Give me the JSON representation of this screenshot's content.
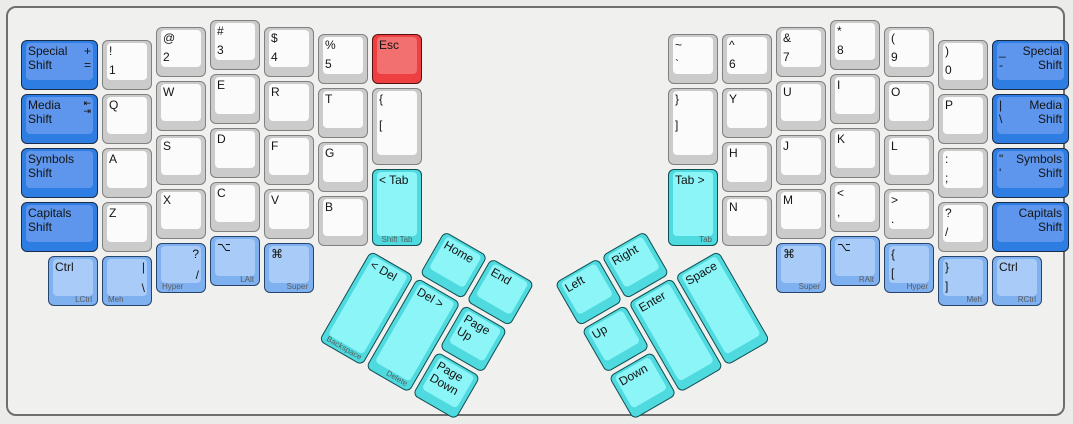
{
  "palette": {
    "gray": {
      "base": "#cbcbcb",
      "top": "#fbfbfb",
      "border": "#808080"
    },
    "blue": {
      "base": "#2e7de2",
      "top": "#5d96ec",
      "border": "#1a2c46"
    },
    "lightblue": {
      "base": "#7fb0f0",
      "top": "#a9cbf7",
      "border": "#27446b"
    },
    "cyan": {
      "base": "#4edade",
      "top": "#8bf5f7",
      "border": "#114d50"
    },
    "red": {
      "base": "#ee4040",
      "top": "#f37070",
      "border": "#561010"
    }
  },
  "case": {
    "fill": "#f0f0ef",
    "border": "#6e6e6e",
    "background": "#ebebea"
  },
  "thumb_groups": {
    "lt": {
      "name": "left-thumb-cluster",
      "cx": 362,
      "cy": 239.5,
      "angle": 30
    },
    "rt": {
      "name": "right-thumb-cluster",
      "cx": 711,
      "cy": 239.5,
      "angle": -30
    }
  },
  "keys": [
    {
      "n": "special-shift-left",
      "c": "blue",
      "x": 11,
      "y": 30,
      "w": 81,
      "L": [
        {
          "p": "tl",
          "t": "Special\nShift"
        },
        {
          "p": "tr",
          "t": "+\n="
        }
      ]
    },
    {
      "n": "exclamation-1",
      "x": 92,
      "y": 30,
      "L": [
        {
          "p": "tl",
          "t": "!"
        },
        {
          "p": "bl",
          "t": "1"
        }
      ]
    },
    {
      "n": "at-2",
      "x": 146,
      "y": 17,
      "L": [
        {
          "p": "tl",
          "t": "@"
        },
        {
          "p": "bl",
          "t": "2"
        }
      ]
    },
    {
      "n": "hash-3",
      "x": 200,
      "y": 10,
      "L": [
        {
          "p": "tl",
          "t": "#"
        },
        {
          "p": "bl",
          "t": "3"
        }
      ]
    },
    {
      "n": "dollar-4",
      "x": 254,
      "y": 17,
      "L": [
        {
          "p": "tl",
          "t": "$"
        },
        {
          "p": "bl",
          "t": "4"
        }
      ]
    },
    {
      "n": "percent-5",
      "x": 308,
      "y": 24,
      "L": [
        {
          "p": "tl",
          "t": "%"
        },
        {
          "p": "bl",
          "t": "5"
        }
      ]
    },
    {
      "n": "esc",
      "c": "red",
      "x": 362,
      "y": 24,
      "L": [
        {
          "p": "tl",
          "t": "Esc"
        }
      ]
    },
    {
      "n": "media-shift-left",
      "c": "blue",
      "x": 11,
      "y": 84,
      "w": 81,
      "L": [
        {
          "p": "tl",
          "t": "Media\nShift"
        },
        {
          "p": "tr",
          "t": "⇤\n⇥",
          "i": 1
        }
      ]
    },
    {
      "n": "q",
      "x": 92,
      "y": 84,
      "L": [
        {
          "p": "tl",
          "t": "Q"
        }
      ]
    },
    {
      "n": "w",
      "x": 146,
      "y": 71,
      "L": [
        {
          "p": "tl",
          "t": "W"
        }
      ]
    },
    {
      "n": "e",
      "x": 200,
      "y": 64,
      "L": [
        {
          "p": "tl",
          "t": "E"
        }
      ]
    },
    {
      "n": "r",
      "x": 254,
      "y": 71,
      "L": [
        {
          "p": "tl",
          "t": "R"
        }
      ]
    },
    {
      "n": "t",
      "x": 308,
      "y": 78,
      "L": [
        {
          "p": "tl",
          "t": "T"
        }
      ]
    },
    {
      "n": "lbrace-lbracket",
      "x": 362,
      "y": 78,
      "h": 81,
      "L": [
        {
          "p": "tl",
          "t": "{"
        },
        {
          "p": "ml",
          "t": "["
        }
      ]
    },
    {
      "n": "symbols-shift-left",
      "c": "blue",
      "x": 11,
      "y": 138,
      "w": 81,
      "L": [
        {
          "p": "tl",
          "t": "Symbols\nShift"
        }
      ]
    },
    {
      "n": "a",
      "x": 92,
      "y": 138,
      "L": [
        {
          "p": "tl",
          "t": "A"
        }
      ]
    },
    {
      "n": "s",
      "x": 146,
      "y": 125,
      "L": [
        {
          "p": "tl",
          "t": "S"
        }
      ]
    },
    {
      "n": "d",
      "x": 200,
      "y": 118,
      "L": [
        {
          "p": "tl",
          "t": "D"
        }
      ]
    },
    {
      "n": "f",
      "x": 254,
      "y": 125,
      "L": [
        {
          "p": "tl",
          "t": "F"
        }
      ]
    },
    {
      "n": "g",
      "x": 308,
      "y": 132,
      "L": [
        {
          "p": "tl",
          "t": "G"
        }
      ]
    },
    {
      "n": "shift-tab-left",
      "c": "cyan",
      "x": 362,
      "y": 159,
      "h": 81,
      "L": [
        {
          "p": "tl",
          "t": "< Tab"
        },
        {
          "p": "fc",
          "t": "Shift Tab",
          "s": 1
        }
      ]
    },
    {
      "n": "capitals-shift-left",
      "c": "blue",
      "x": 11,
      "y": 192,
      "w": 81,
      "L": [
        {
          "p": "tl",
          "t": "Capitals\nShift"
        }
      ]
    },
    {
      "n": "z",
      "x": 92,
      "y": 192,
      "L": [
        {
          "p": "tl",
          "t": "Z"
        }
      ]
    },
    {
      "n": "x",
      "x": 146,
      "y": 179,
      "L": [
        {
          "p": "tl",
          "t": "X"
        }
      ]
    },
    {
      "n": "c",
      "x": 200,
      "y": 172,
      "L": [
        {
          "p": "tl",
          "t": "C"
        }
      ]
    },
    {
      "n": "v",
      "x": 254,
      "y": 179,
      "L": [
        {
          "p": "tl",
          "t": "V"
        }
      ]
    },
    {
      "n": "b",
      "x": 308,
      "y": 186,
      "L": [
        {
          "p": "tl",
          "t": "B"
        }
      ]
    },
    {
      "n": "lctrl",
      "c": "lightblue",
      "x": 38,
      "y": 246,
      "L": [
        {
          "p": "tl",
          "t": "Ctrl"
        },
        {
          "p": "fr",
          "t": "LCtrl",
          "s": 1
        }
      ]
    },
    {
      "n": "meh-left",
      "c": "lightblue",
      "x": 92,
      "y": 246,
      "L": [
        {
          "p": "tr",
          "t": "|"
        },
        {
          "p": "br",
          "t": "\\"
        },
        {
          "p": "fl",
          "t": "Meh",
          "s": 1
        }
      ]
    },
    {
      "n": "hyper-left",
      "c": "lightblue",
      "x": 146,
      "y": 233,
      "L": [
        {
          "p": "tr",
          "t": "?"
        },
        {
          "p": "br",
          "t": "/"
        },
        {
          "p": "fl",
          "t": "Hyper",
          "s": 1
        }
      ]
    },
    {
      "n": "lalt",
      "c": "lightblue",
      "x": 200,
      "y": 226,
      "L": [
        {
          "p": "tl",
          "t": "⌥"
        },
        {
          "p": "fr",
          "t": "LAlt",
          "s": 1
        }
      ]
    },
    {
      "n": "super-left",
      "c": "lightblue",
      "x": 254,
      "y": 233,
      "L": [
        {
          "p": "tl",
          "t": "⌘"
        },
        {
          "p": "fr",
          "t": "Super",
          "s": 1
        }
      ]
    },
    {
      "n": "home",
      "c": "cyan",
      "g": "lt",
      "x": 54,
      "y": -54,
      "L": [
        {
          "p": "tl",
          "t": "Home"
        }
      ]
    },
    {
      "n": "end",
      "c": "cyan",
      "g": "lt",
      "x": 108,
      "y": -54,
      "L": [
        {
          "p": "tl",
          "t": "End"
        }
      ]
    },
    {
      "n": "backspace",
      "c": "cyan",
      "g": "lt",
      "x": 0,
      "y": 0,
      "h": 108,
      "L": [
        {
          "p": "tl",
          "t": "< Del"
        },
        {
          "p": "fl",
          "t": "Backspace",
          "s": 1
        }
      ]
    },
    {
      "n": "delete",
      "c": "cyan",
      "g": "lt",
      "x": 54,
      "y": 0,
      "h": 108,
      "L": [
        {
          "p": "tl",
          "t": "Del >"
        },
        {
          "p": "fr",
          "t": "Delete",
          "s": 1
        }
      ]
    },
    {
      "n": "page-up",
      "c": "cyan",
      "g": "lt",
      "x": 108,
      "y": 0,
      "L": [
        {
          "p": "tl",
          "t": "Page\nUp"
        }
      ]
    },
    {
      "n": "page-down",
      "c": "cyan",
      "g": "lt",
      "x": 108,
      "y": 54,
      "L": [
        {
          "p": "tl",
          "t": "Page\nDown"
        }
      ]
    },
    {
      "n": "tilde-grave",
      "x": 658,
      "y": 24,
      "L": [
        {
          "p": "tl",
          "t": "~"
        },
        {
          "p": "bl",
          "t": "`"
        }
      ]
    },
    {
      "n": "caret-6",
      "x": 712,
      "y": 24,
      "L": [
        {
          "p": "tl",
          "t": "^"
        },
        {
          "p": "bl",
          "t": "6"
        }
      ]
    },
    {
      "n": "ampersand-7",
      "x": 766,
      "y": 17,
      "L": [
        {
          "p": "tl",
          "t": "&"
        },
        {
          "p": "bl",
          "t": "7"
        }
      ]
    },
    {
      "n": "asterisk-8",
      "x": 820,
      "y": 10,
      "L": [
        {
          "p": "tl",
          "t": "*"
        },
        {
          "p": "bl",
          "t": "8"
        }
      ]
    },
    {
      "n": "lparen-9",
      "x": 874,
      "y": 17,
      "L": [
        {
          "p": "tl",
          "t": "("
        },
        {
          "p": "bl",
          "t": "9"
        }
      ]
    },
    {
      "n": "rparen-0",
      "x": 928,
      "y": 30,
      "L": [
        {
          "p": "tl",
          "t": ")"
        },
        {
          "p": "bl",
          "t": "0"
        }
      ]
    },
    {
      "n": "special-shift-right",
      "c": "blue",
      "x": 982,
      "y": 30,
      "w": 81,
      "L": [
        {
          "p": "tl",
          "t": "_\n-"
        },
        {
          "p": "tr",
          "t": "Special\nShift"
        }
      ]
    },
    {
      "n": "rbrace-rbracket",
      "x": 658,
      "y": 78,
      "h": 81,
      "L": [
        {
          "p": "tl",
          "t": "}"
        },
        {
          "p": "ml",
          "t": "]"
        }
      ]
    },
    {
      "n": "y",
      "x": 712,
      "y": 78,
      "L": [
        {
          "p": "tl",
          "t": "Y"
        }
      ]
    },
    {
      "n": "u",
      "x": 766,
      "y": 71,
      "L": [
        {
          "p": "tl",
          "t": "U"
        }
      ]
    },
    {
      "n": "i",
      "x": 820,
      "y": 64,
      "L": [
        {
          "p": "tl",
          "t": "I"
        }
      ]
    },
    {
      "n": "o",
      "x": 874,
      "y": 71,
      "L": [
        {
          "p": "tl",
          "t": "O"
        }
      ]
    },
    {
      "n": "p",
      "x": 928,
      "y": 84,
      "L": [
        {
          "p": "tl",
          "t": "P"
        }
      ]
    },
    {
      "n": "media-shift-right",
      "c": "blue",
      "x": 982,
      "y": 84,
      "w": 81,
      "L": [
        {
          "p": "tl",
          "t": "|\n\\"
        },
        {
          "p": "tr",
          "t": "Media\nShift"
        }
      ]
    },
    {
      "n": "h",
      "x": 712,
      "y": 132,
      "L": [
        {
          "p": "tl",
          "t": "H"
        }
      ]
    },
    {
      "n": "j",
      "x": 766,
      "y": 125,
      "L": [
        {
          "p": "tl",
          "t": "J"
        }
      ]
    },
    {
      "n": "k",
      "x": 820,
      "y": 118,
      "L": [
        {
          "p": "tl",
          "t": "K"
        }
      ]
    },
    {
      "n": "l",
      "x": 874,
      "y": 125,
      "L": [
        {
          "p": "tl",
          "t": "L"
        }
      ]
    },
    {
      "n": "colon-semicolon",
      "x": 928,
      "y": 138,
      "L": [
        {
          "p": "tl",
          "t": ":"
        },
        {
          "p": "bl",
          "t": ";"
        }
      ]
    },
    {
      "n": "symbols-shift-right",
      "c": "blue",
      "x": 982,
      "y": 138,
      "w": 81,
      "L": [
        {
          "p": "tl",
          "t": "\"\n'"
        },
        {
          "p": "tr",
          "t": "Symbols\nShift"
        }
      ]
    },
    {
      "n": "tab-right",
      "c": "cyan",
      "x": 658,
      "y": 159,
      "h": 81,
      "L": [
        {
          "p": "tl",
          "t": "Tab >"
        },
        {
          "p": "fr",
          "t": "Tab",
          "s": 1
        }
      ]
    },
    {
      "n": "n",
      "x": 712,
      "y": 186,
      "L": [
        {
          "p": "tl",
          "t": "N"
        }
      ]
    },
    {
      "n": "m",
      "x": 766,
      "y": 179,
      "L": [
        {
          "p": "tl",
          "t": "M"
        }
      ]
    },
    {
      "n": "less-comma",
      "x": 820,
      "y": 172,
      "L": [
        {
          "p": "tl",
          "t": "<"
        },
        {
          "p": "bl",
          "t": ","
        }
      ]
    },
    {
      "n": "greater-period",
      "x": 874,
      "y": 179,
      "L": [
        {
          "p": "tl",
          "t": ">"
        },
        {
          "p": "bl",
          "t": "."
        }
      ]
    },
    {
      "n": "question-slash",
      "x": 928,
      "y": 192,
      "L": [
        {
          "p": "tl",
          "t": "?"
        },
        {
          "p": "bl",
          "t": "/"
        }
      ]
    },
    {
      "n": "capitals-shift-right",
      "c": "blue",
      "x": 982,
      "y": 192,
      "w": 81,
      "L": [
        {
          "p": "tr",
          "t": "Capitals\nShift"
        }
      ]
    },
    {
      "n": "super-right",
      "c": "lightblue",
      "x": 766,
      "y": 233,
      "L": [
        {
          "p": "tl",
          "t": "⌘"
        },
        {
          "p": "fr",
          "t": "Super",
          "s": 1
        }
      ]
    },
    {
      "n": "ralt",
      "c": "lightblue",
      "x": 820,
      "y": 226,
      "L": [
        {
          "p": "tl",
          "t": "⌥"
        },
        {
          "p": "fr",
          "t": "RAlt",
          "s": 1
        }
      ]
    },
    {
      "n": "hyper-right",
      "c": "lightblue",
      "x": 874,
      "y": 233,
      "L": [
        {
          "p": "tl",
          "t": "{"
        },
        {
          "p": "bl",
          "t": "["
        },
        {
          "p": "fr",
          "t": "Hyper",
          "s": 1
        }
      ]
    },
    {
      "n": "meh-right",
      "c": "lightblue",
      "x": 928,
      "y": 246,
      "L": [
        {
          "p": "tl",
          "t": "}"
        },
        {
          "p": "bl",
          "t": "]"
        },
        {
          "p": "fr",
          "t": "Meh",
          "s": 1
        }
      ]
    },
    {
      "n": "rctrl",
      "c": "lightblue",
      "x": 982,
      "y": 246,
      "L": [
        {
          "p": "tl",
          "t": "Ctrl"
        },
        {
          "p": "fr",
          "t": "RCtrl",
          "s": 1
        }
      ]
    },
    {
      "n": "arrow-left",
      "c": "cyan",
      "g": "rt",
      "x": -162,
      "y": -54,
      "L": [
        {
          "p": "tl",
          "t": "Left"
        }
      ]
    },
    {
      "n": "arrow-right",
      "c": "cyan",
      "g": "rt",
      "x": -108,
      "y": -54,
      "L": [
        {
          "p": "tl",
          "t": "Right"
        }
      ]
    },
    {
      "n": "arrow-up",
      "c": "cyan",
      "g": "rt",
      "x": -162,
      "y": 0,
      "L": [
        {
          "p": "tl",
          "t": "Up"
        }
      ]
    },
    {
      "n": "arrow-down",
      "c": "cyan",
      "g": "rt",
      "x": -162,
      "y": 54,
      "L": [
        {
          "p": "tl",
          "t": "Down"
        }
      ]
    },
    {
      "n": "enter",
      "c": "cyan",
      "g": "rt",
      "x": -108,
      "y": 0,
      "h": 108,
      "L": [
        {
          "p": "tl",
          "t": "Enter"
        }
      ]
    },
    {
      "n": "space",
      "c": "cyan",
      "g": "rt",
      "x": -54,
      "y": 0,
      "h": 108,
      "L": [
        {
          "p": "tl",
          "t": "Space"
        }
      ]
    }
  ]
}
